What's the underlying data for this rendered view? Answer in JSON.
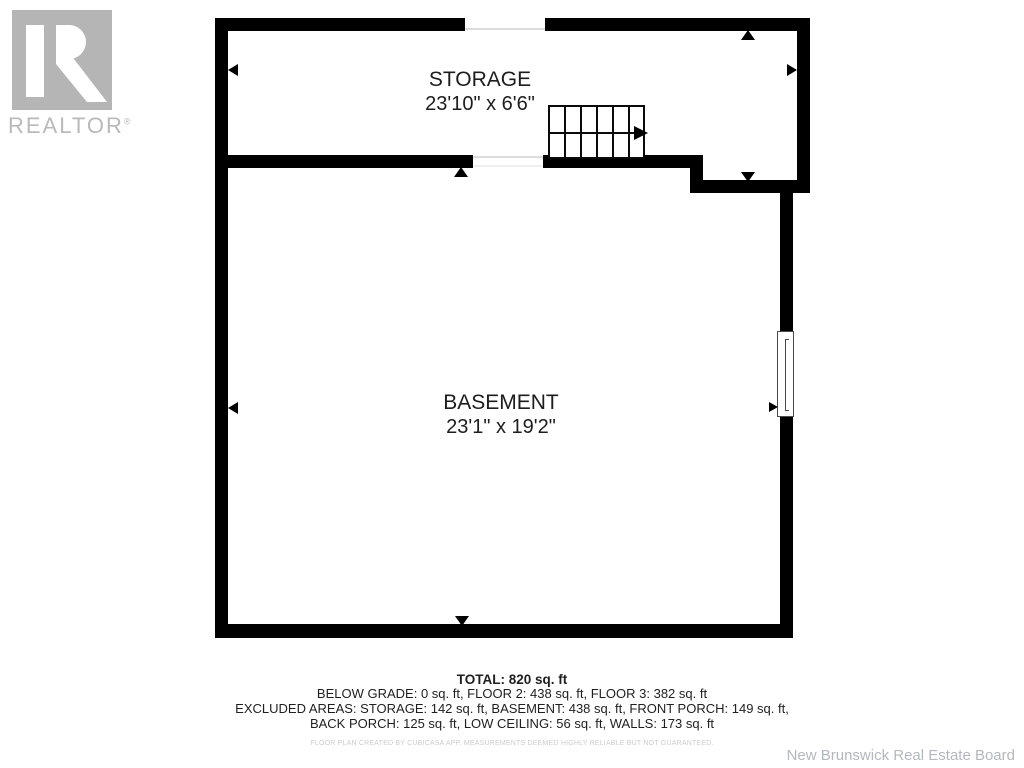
{
  "branding": {
    "logo_word": "REALTOR",
    "registered_mark": "®"
  },
  "floor_plan": {
    "rooms": [
      {
        "name": "STORAGE",
        "dimensions": "23'10\" x 6'6\""
      },
      {
        "name": "BASEMENT",
        "dimensions": "23'1\" x 19'2\""
      }
    ]
  },
  "summary": {
    "total_line": "TOTAL: 820 sq. ft",
    "line2": "BELOW GRADE: 0 sq. ft, FLOOR 2: 438 sq. ft, FLOOR 3: 382 sq. ft",
    "line3": "EXCLUDED AREAS: STORAGE: 142 sq. ft, BASEMENT: 438 sq. ft, FRONT PORCH: 149 sq. ft,",
    "line4": "BACK PORCH: 125 sq. ft, LOW CEILING: 56 sq. ft, WALLS: 173 sq. ft",
    "disclaimer": "FLOOR PLAN CREATED BY CUBICASA APP. MEASUREMENTS DEEMED HIGHLY RELIABLE BUT NOT GUARANTEED."
  },
  "footer": {
    "attribution": "New Brunswick Real Estate Board"
  },
  "colors": {
    "wall": "#000000",
    "logo_gray": "#b5b5b5",
    "logo_text_gray": "#b9b9b9",
    "label_text": "#1d1d1d",
    "disclaimer_gray": "#cccccc",
    "attribution_gray": "#b3b8bd"
  }
}
